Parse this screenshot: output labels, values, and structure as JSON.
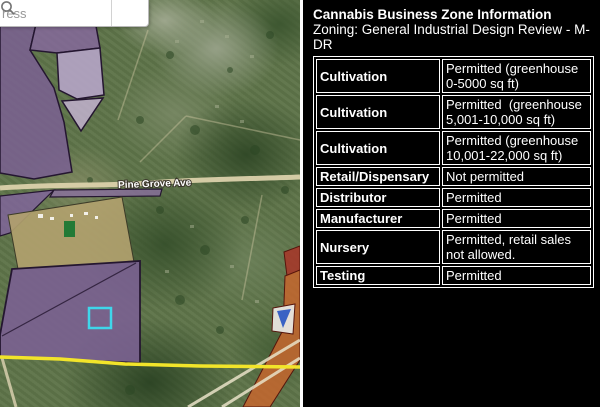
{
  "search": {
    "placeholder_visible": "ress",
    "icon": "magnifier-icon"
  },
  "map": {
    "road_label": "Pine Grove Ave",
    "features": {
      "selected_parcel_highlight": "cyan square outline",
      "zone_boundary_line": "yellow horizontal line",
      "purple_zones": "industrial zoning overlay",
      "orange_zones": "commercial zoning overlay bottom right"
    },
    "colors": {
      "selection_cyan": "#3fd6ea",
      "boundary_yellow": "#f2e42a",
      "zone_purple": "#7a6191",
      "zone_purple_light": "#b5a4c6",
      "zone_orange": "#c5662e",
      "zone_red": "#a83528",
      "road_tan": "#dbd1ab"
    }
  },
  "panel": {
    "title": "Cannabis Business Zone Information",
    "zoning": "Zoning: General Industrial Design Review - M-DR",
    "colors": {
      "background": "#000000",
      "text": "#ffffff",
      "border": "#ffffff",
      "separator": "#fdfdfd"
    },
    "table": {
      "rows": [
        {
          "type": "Cultivation",
          "status": "Permitted (greenhouse 0-5000 sq ft)"
        },
        {
          "type": "Cultivation",
          "status": "Permitted  (greenhouse 5,001-10,000 sq ft)"
        },
        {
          "type": "Cultivation",
          "status": "Permitted (greenhouse 10,001-22,000 sq ft)"
        },
        {
          "type": "Retail/Dispensary",
          "status": "Not permitted"
        },
        {
          "type": "Distributor",
          "status": "Permitted"
        },
        {
          "type": "Manufacturer",
          "status": "Permitted"
        },
        {
          "type": "Nursery",
          "status": "Permitted, retail sales not allowed."
        },
        {
          "type": "Testing",
          "status": "Permitted"
        }
      ]
    }
  }
}
